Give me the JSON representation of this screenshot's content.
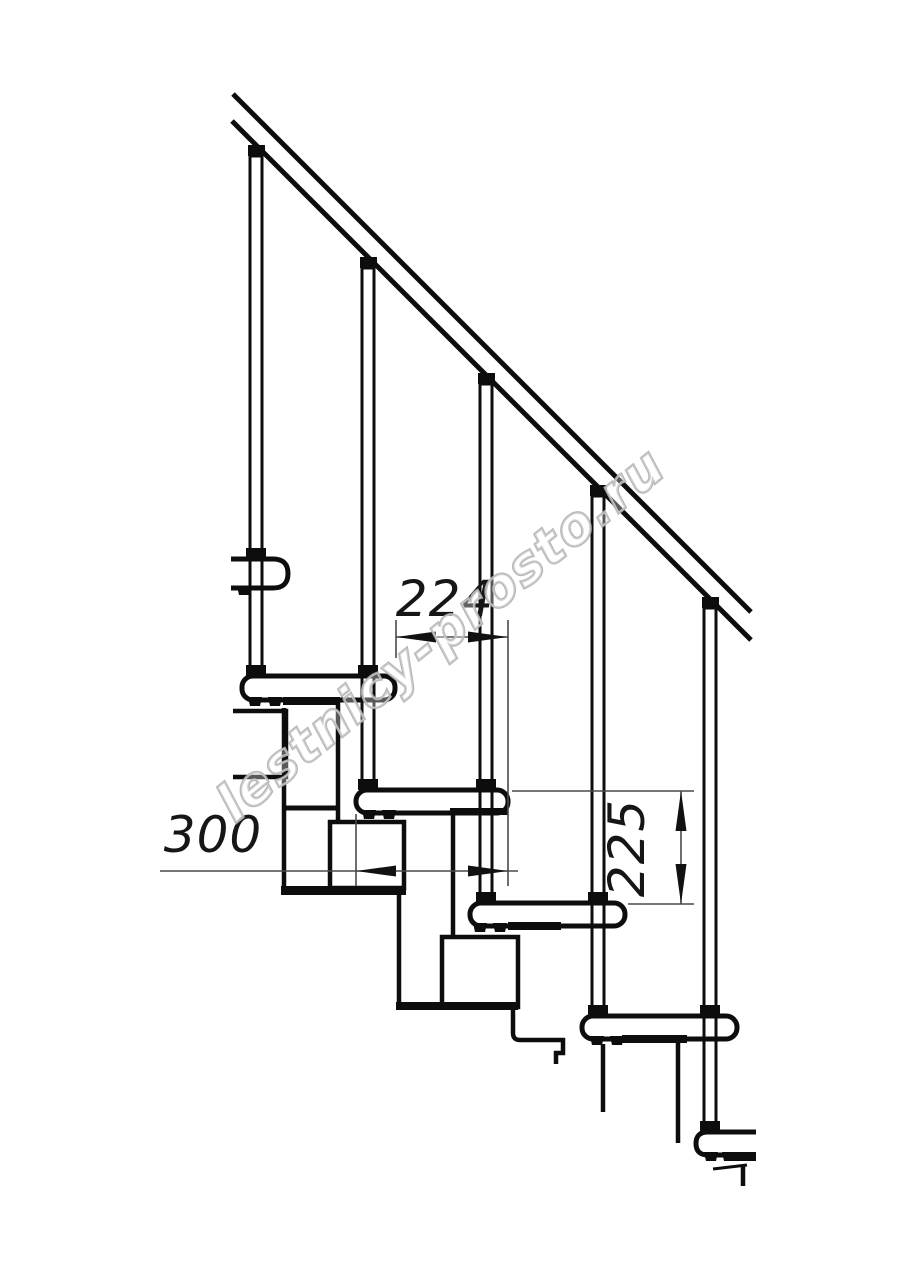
{
  "figure": {
    "kind": "modular staircase side elevation technical drawing",
    "background": "#ffffff",
    "ink_color": "#0d0d0d",
    "dimension_line_color": "#4a4a4a",
    "dimension_text_color": "#161616"
  },
  "dimensions": {
    "step_run": {
      "label": "224",
      "orientation": "horizontal"
    },
    "tread_depth": {
      "label": "300",
      "orientation": "horizontal"
    },
    "step_rise": {
      "label": "225",
      "orientation": "vertical"
    }
  },
  "watermark": {
    "text": "lestnicy-prosto.ru",
    "stroke_color": "#b3b3b3",
    "angle_deg": -39
  },
  "structure": {
    "handrail_count": 1,
    "baluster_count": 5,
    "tread_count": 6
  }
}
